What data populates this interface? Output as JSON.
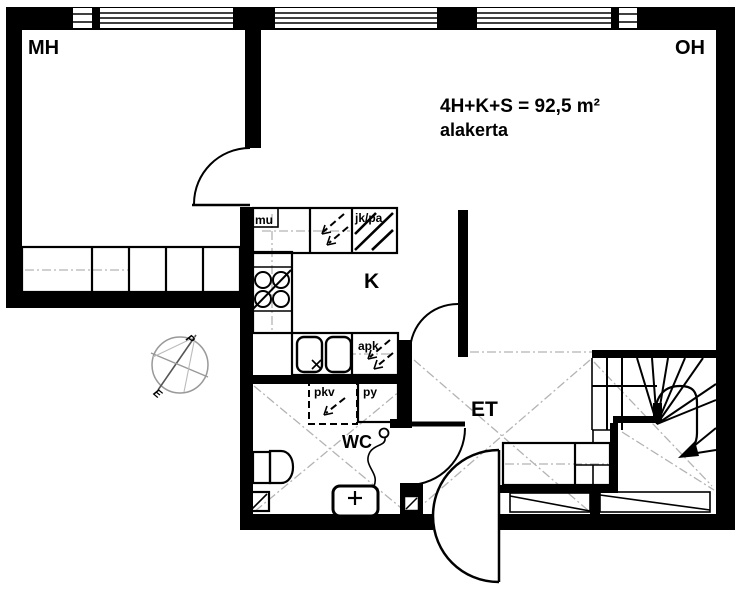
{
  "plan": {
    "area_title": "4H+K+S = 92,5 m²",
    "floor_label": "alakerta",
    "rooms": {
      "bedroom": "MH",
      "living_room": "OH",
      "kitchen": "K",
      "entrance_hall": "ET",
      "wc": "WC"
    },
    "appliances": {
      "microwave": "mu",
      "fridge_freezer": "jk/pa",
      "dishwasher": "apk",
      "washer_reservation": "pkv",
      "washer": "py"
    },
    "compass": {
      "north": "P",
      "south": "E"
    },
    "colors": {
      "wall": "#000000",
      "background": "#ffffff",
      "centerline": "#b3b3b3"
    }
  }
}
